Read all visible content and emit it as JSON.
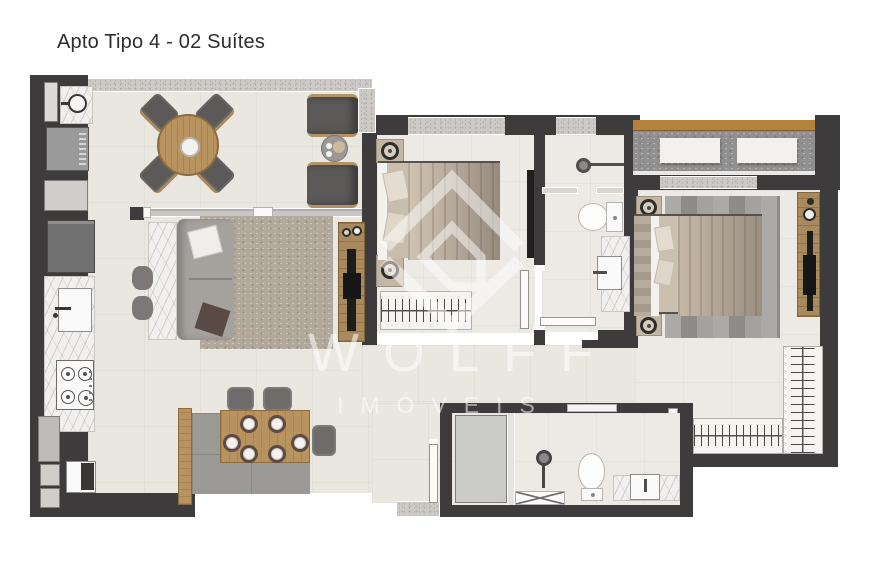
{
  "header": {
    "title": "Apto Tipo 4 - 02 Suítes"
  },
  "watermark": {
    "brand": "WOLFF",
    "sub": "IMÓVEIS"
  },
  "colors": {
    "wall": "#3d3b3b",
    "floor": "#eae6e0",
    "floorSuite": "#edeae5",
    "windowGlass": "#ccc9c6",
    "marble": "#f1f0ee",
    "wood": "#b9935f",
    "deck": "#b5823d",
    "panelWood": "#a98a5e",
    "balconyFloor": "#909090",
    "sofa": "#a5a19d",
    "rugLiving": "#b3a89c",
    "rugSuite": "#9e9c98",
    "chair": "#5c5a58",
    "appliance": "#9a9a9a",
    "fridge": "#717171",
    "counterGray": "#9b9a96",
    "watermark": "rgba(255,255,255,0.55)"
  }
}
